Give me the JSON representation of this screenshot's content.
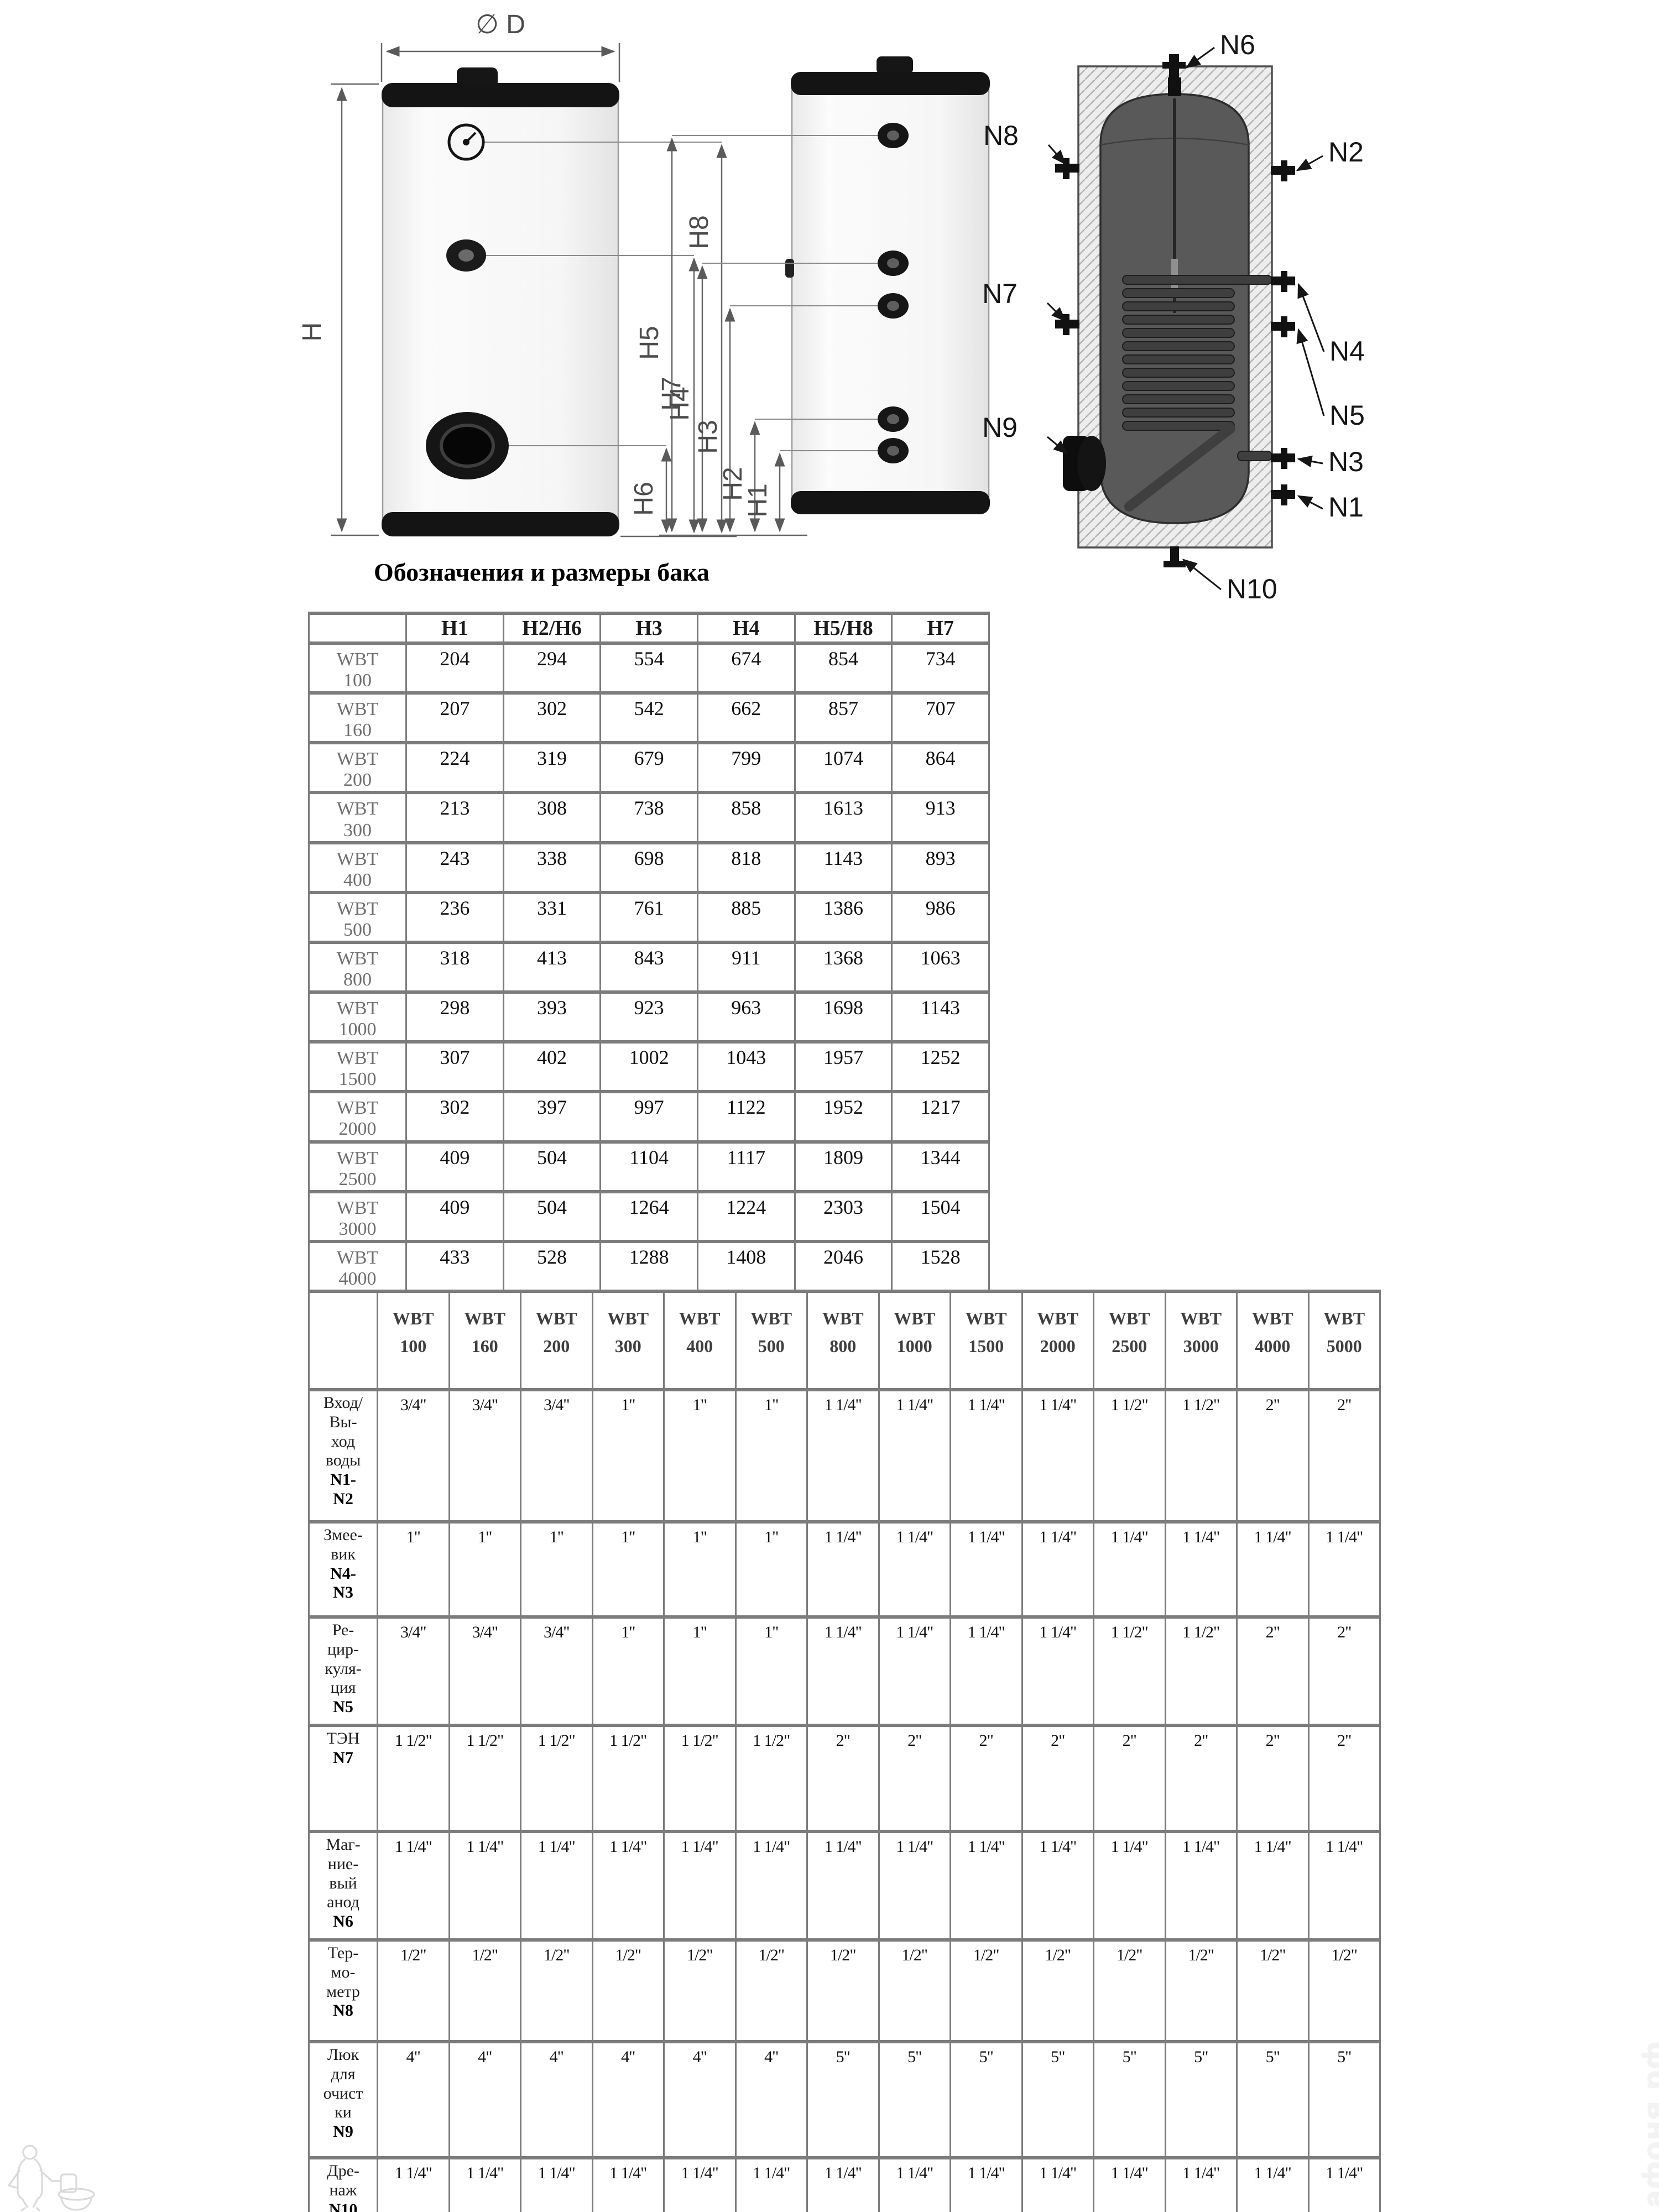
{
  "section_title": "Обозначения и размеры бака",
  "diagram": {
    "front_view": {
      "diameter": "∅ D",
      "height": "H",
      "h8": "H8",
      "h7": "H7",
      "h6": "H6"
    },
    "side_view": {
      "h5": "H5",
      "h4": "H4",
      "h3": "H3",
      "h2": "H2",
      "h1": "H1"
    },
    "section_view": {
      "n1": "N1",
      "n2": "N2",
      "n3": "N3",
      "n4": "N4",
      "n5": "N5",
      "n6": "N6",
      "n7": "N7",
      "n8": "N8",
      "n9": "N9",
      "n10": "N10"
    }
  },
  "dimensions_table": {
    "header": [
      "",
      "H1",
      "H2/H6",
      "H3",
      "H4",
      "H5/H8",
      "H7"
    ],
    "rows": [
      {
        "model": "WBT\n100",
        "values": [
          "204",
          "294",
          "554",
          "674",
          "854",
          "734"
        ]
      },
      {
        "model": "WBT\n160",
        "values": [
          "207",
          "302",
          "542",
          "662",
          "857",
          "707"
        ]
      },
      {
        "model": "WBT\n200",
        "values": [
          "224",
          "319",
          "679",
          "799",
          "1074",
          "864"
        ]
      },
      {
        "model": "WBT\n300",
        "values": [
          "213",
          "308",
          "738",
          "858",
          "1613",
          "913"
        ]
      },
      {
        "model": "WBT\n400",
        "values": [
          "243",
          "338",
          "698",
          "818",
          "1143",
          "893"
        ]
      },
      {
        "model": "WBT\n500",
        "values": [
          "236",
          "331",
          "761",
          "885",
          "1386",
          "986"
        ]
      },
      {
        "model": "WBT\n800",
        "values": [
          "318",
          "413",
          "843",
          "911",
          "1368",
          "1063"
        ]
      },
      {
        "model": "WBT\n1000",
        "values": [
          "298",
          "393",
          "923",
          "963",
          "1698",
          "1143"
        ]
      },
      {
        "model": "WBT\n1500",
        "values": [
          "307",
          "402",
          "1002",
          "1043",
          "1957",
          "1252"
        ]
      },
      {
        "model": "WBT\n2000",
        "values": [
          "302",
          "397",
          "997",
          "1122",
          "1952",
          "1217"
        ]
      },
      {
        "model": "WBT\n2500",
        "values": [
          "409",
          "504",
          "1104",
          "1117",
          "1809",
          "1344"
        ]
      },
      {
        "model": "WBT\n3000",
        "values": [
          "409",
          "504",
          "1264",
          "1224",
          "2303",
          "1504"
        ]
      },
      {
        "model": "WBT\n4000",
        "values": [
          "433",
          "528",
          "1288",
          "1408",
          "2046",
          "1528"
        ]
      },
      {
        "model": "WBT\n5000",
        "values": [
          "429",
          "524",
          "1508",
          "1624",
          "2529",
          "1744"
        ]
      }
    ]
  },
  "connections_table": {
    "models": [
      "WBT\n100",
      "WBT\n160",
      "WBT\n200",
      "WBT\n300",
      "WBT\n400",
      "WBT\n500",
      "WBT\n800",
      "WBT\n1000",
      "WBT\n1500",
      "WBT\n2000",
      "WBT\n2500",
      "WBT\n3000",
      "WBT\n4000",
      "WBT\n5000"
    ],
    "rows": [
      {
        "label": "Вход/\nВы-\nход\nводы",
        "code": "N1-\nN2",
        "values": [
          "3/4\"",
          "3/4\"",
          "3/4\"",
          "1\"",
          "1\"",
          "1\"",
          "1 1/4\"",
          "1 1/4\"",
          "1 1/4\"",
          "1 1/4\"",
          "1 1/2\"",
          "1 1/2\"",
          "2\"",
          "2\""
        ]
      },
      {
        "label": "Змее-\nвик",
        "code": "N4-\nN3",
        "values": [
          "1\"",
          "1\"",
          "1\"",
          "1\"",
          "1\"",
          "1\"",
          "1 1/4\"",
          "1 1/4\"",
          "1 1/4\"",
          "1 1/4\"",
          "1 1/4\"",
          "1 1/4\"",
          "1 1/4\"",
          "1 1/4\""
        ]
      },
      {
        "label": "Ре-\nцир-\nкуля-\nция",
        "code": "N5",
        "values": [
          "3/4\"",
          "3/4\"",
          "3/4\"",
          "1\"",
          "1\"",
          "1\"",
          "1 1/4\"",
          "1 1/4\"",
          "1 1/4\"",
          "1 1/4\"",
          "1 1/2\"",
          "1 1/2\"",
          "2\"",
          "2\""
        ]
      },
      {
        "label": "ТЭН",
        "code": "N7",
        "values": [
          "1 1/2\"",
          "1 1/2\"",
          "1 1/2\"",
          "1 1/2\"",
          "1 1/2\"",
          "1 1/2\"",
          "2\"",
          "2\"",
          "2\"",
          "2\"",
          "2\"",
          "2\"",
          "2\"",
          "2\""
        ]
      },
      {
        "label": "Маг-\nние-\nвый\nанод",
        "code": "N6",
        "values": [
          "1 1/4\"",
          "1 1/4\"",
          "1 1/4\"",
          "1 1/4\"",
          "1 1/4\"",
          "1 1/4\"",
          "1 1/4\"",
          "1 1/4\"",
          "1 1/4\"",
          "1 1/4\"",
          "1 1/4\"",
          "1 1/4\"",
          "1 1/4\"",
          "1 1/4\""
        ]
      },
      {
        "label": "Тер-\nмо-\nметр",
        "code": "N8",
        "values": [
          "1/2\"",
          "1/2\"",
          "1/2\"",
          "1/2\"",
          "1/2\"",
          "1/2\"",
          "1/2\"",
          "1/2\"",
          "1/2\"",
          "1/2\"",
          "1/2\"",
          "1/2\"",
          "1/2\"",
          "1/2\""
        ]
      },
      {
        "label": "Люк\nдля\nочист\nки",
        "code": "N9",
        "values": [
          "4\"",
          "4\"",
          "4\"",
          "4\"",
          "4\"",
          "4\"",
          "5\"",
          "5\"",
          "5\"",
          "5\"",
          "5\"",
          "5\"",
          "5\"",
          "5\""
        ]
      },
      {
        "label": "Дре-\nнаж",
        "code": "N10",
        "values": [
          "1 1/4\"",
          "1 1/4\"",
          "1 1/4\"",
          "1 1/4\"",
          "1 1/4\"",
          "1 1/4\"",
          "1 1/4\"",
          "1 1/4\"",
          "1 1/4\"",
          "1 1/4\"",
          "1 1/4\"",
          "1 1/4\"",
          "1 1/4\"",
          "1 1/4\""
        ]
      }
    ]
  },
  "watermark": {
    "brand": "афоня.рф"
  }
}
